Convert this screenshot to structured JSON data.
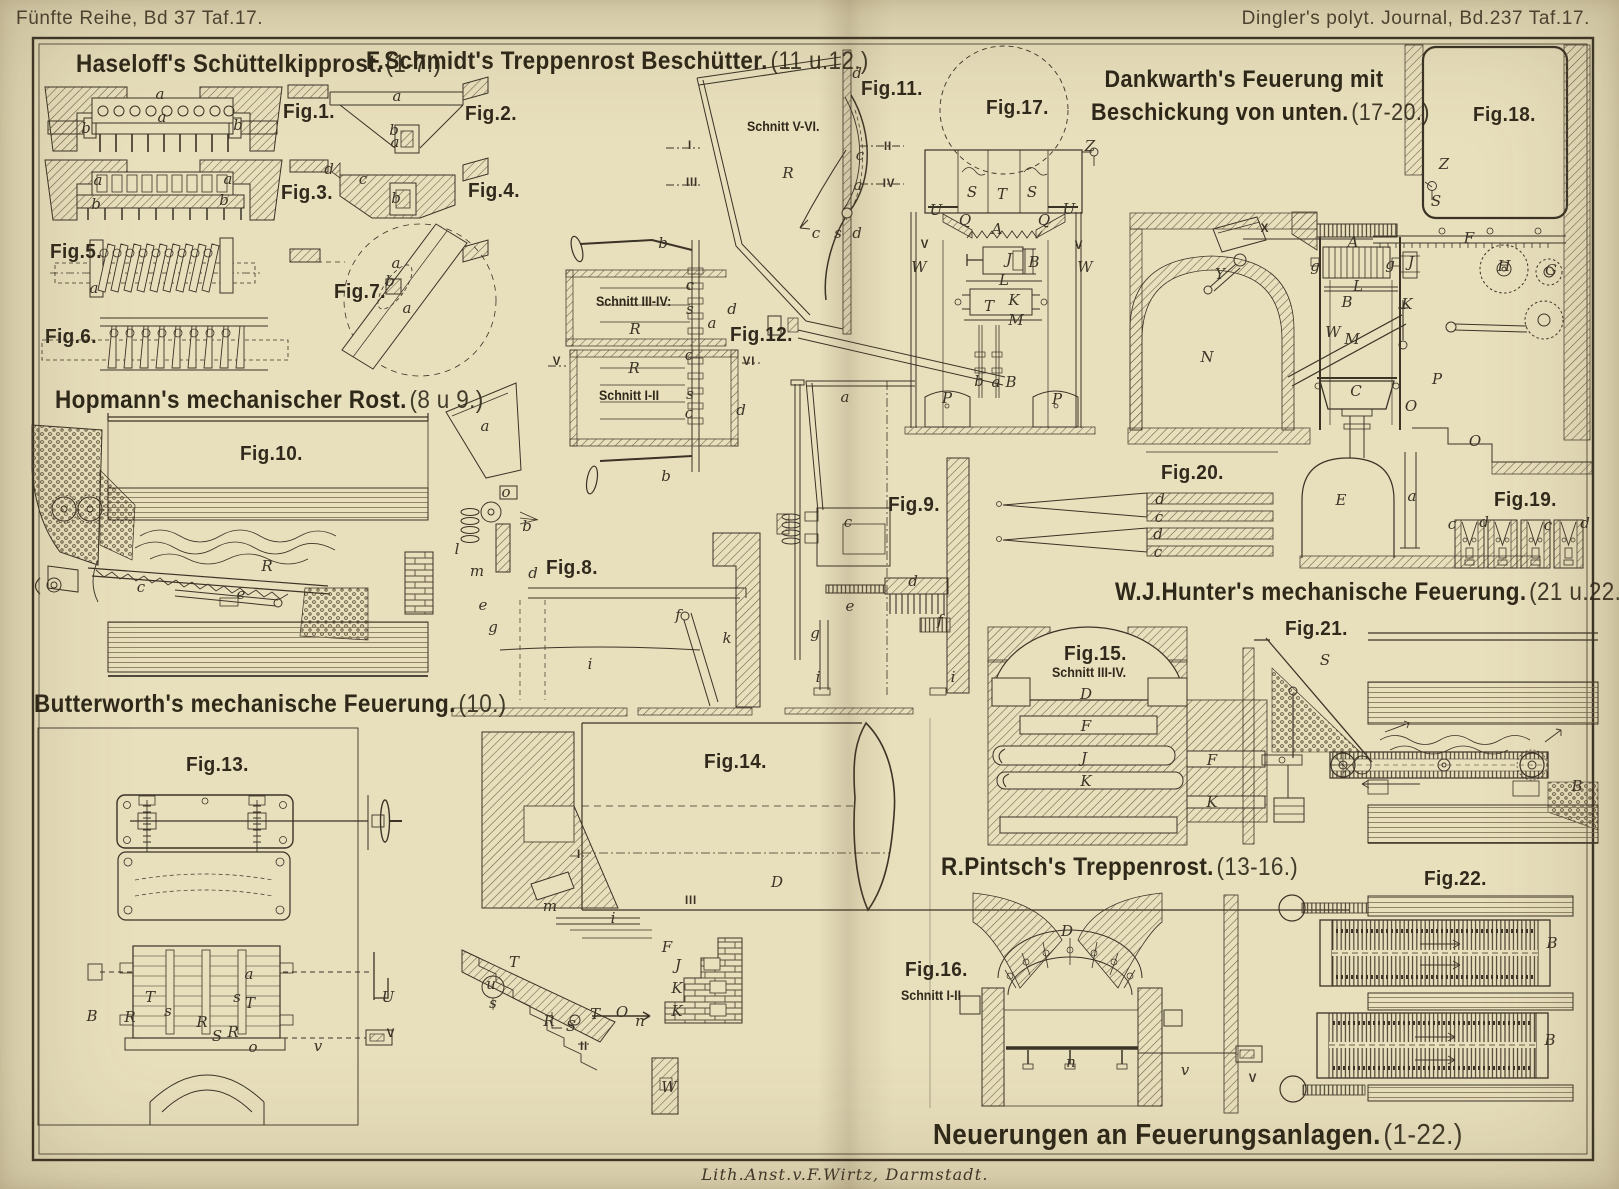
{
  "page": {
    "header_left": "Fünfte Reihe, Bd 37 Taf.17.",
    "header_right": "Dingler's polyt. Journal, Bd.237 Taf.17.",
    "credit": "Lith.Anst.v.F.Wirtz, Darmstadt.",
    "colors": {
      "paper": "#e8dfbd",
      "ink": "#3b3326",
      "hatch": "#6b5c44"
    }
  },
  "titles": {
    "main": {
      "text": "Neuerungen an Feuerungsanlagen.",
      "range": "(1-22.)"
    },
    "haseloff": {
      "text": "Haseloff's Schüttelkipprost.",
      "range": "(1-7.)"
    },
    "schmidt": {
      "text": "F.Schmidt's Treppenrost Beschütter.",
      "range": "(11 u.12.)"
    },
    "dankwarth1": {
      "text": "Dankwarth's Feuerung mit"
    },
    "dankwarth2": {
      "text": "Beschickung von unten.",
      "range": "(17-20.)"
    },
    "hopmann": {
      "text": "Hopmann's mechanischer Rost.",
      "range": "(8 u 9.)"
    },
    "butterworth": {
      "text": "Butterworth's mechanische Feuerung.",
      "range": "(10.)"
    },
    "hunter": {
      "text": "W.J.Hunter's mechanische Feuerung.",
      "range": "(21 u.22.)"
    },
    "pintsch": {
      "text": "R.Pintsch's Treppenrost.",
      "range": "(13-16.)"
    }
  },
  "figures": {
    "f1": {
      "label": "Fig.1."
    },
    "f2": {
      "label": "Fig.2."
    },
    "f3": {
      "label": "Fig.3."
    },
    "f4": {
      "label": "Fig.4."
    },
    "f5": {
      "label": "Fig.5."
    },
    "f6": {
      "label": "Fig.6."
    },
    "f7": {
      "label": "Fig.7."
    },
    "f8": {
      "label": "Fig.8."
    },
    "f9": {
      "label": "Fig.9."
    },
    "f10": {
      "label": "Fig.10."
    },
    "f11": {
      "label": "Fig.11."
    },
    "f12": {
      "label": "Fig.12."
    },
    "f13": {
      "label": "Fig.13."
    },
    "f14": {
      "label": "Fig.14."
    },
    "f15": {
      "label": "Fig.15."
    },
    "f16": {
      "label": "Fig.16."
    },
    "f17": {
      "label": "Fig.17."
    },
    "f18": {
      "label": "Fig.18."
    },
    "f19": {
      "label": "Fig.19."
    },
    "f20": {
      "label": "Fig.20."
    },
    "f21": {
      "label": "Fig.21."
    },
    "f22": {
      "label": "Fig.22."
    }
  },
  "cuts": {
    "c11": "Schnitt V-VI.",
    "c12a": "Schnitt III-IV:",
    "c12b": "Schnitt I-II",
    "c15": "Schnitt III-IV.",
    "c16": "Schnitt I-II"
  },
  "part_labels": [
    {
      "t": "a",
      "x": 160,
      "y": 94
    },
    {
      "t": "a",
      "x": 162,
      "y": 117
    },
    {
      "t": "b",
      "x": 86,
      "y": 128
    },
    {
      "t": "b",
      "x": 238,
      "y": 125
    },
    {
      "t": "a",
      "x": 397,
      "y": 96
    },
    {
      "t": "b",
      "x": 394,
      "y": 130
    },
    {
      "t": "a",
      "x": 395,
      "y": 142
    },
    {
      "t": "a",
      "x": 98,
      "y": 180
    },
    {
      "t": "a",
      "x": 228,
      "y": 179
    },
    {
      "t": "b",
      "x": 96,
      "y": 204
    },
    {
      "t": "b",
      "x": 224,
      "y": 200
    },
    {
      "t": "d",
      "x": 329,
      "y": 169
    },
    {
      "t": "c",
      "x": 363,
      "y": 179
    },
    {
      "t": "b",
      "x": 396,
      "y": 198
    },
    {
      "t": "a",
      "x": 94,
      "y": 288
    },
    {
      "t": "a",
      "x": 396,
      "y": 263
    },
    {
      "t": "b",
      "x": 390,
      "y": 281
    },
    {
      "t": "a",
      "x": 407,
      "y": 308
    },
    {
      "t": "a",
      "x": 485,
      "y": 426
    },
    {
      "t": "o",
      "x": 506,
      "y": 492
    },
    {
      "t": "b",
      "x": 527,
      "y": 526
    },
    {
      "t": "l",
      "x": 457,
      "y": 549
    },
    {
      "t": "m",
      "x": 477,
      "y": 571
    },
    {
      "t": "d",
      "x": 533,
      "y": 573
    },
    {
      "t": "e",
      "x": 483,
      "y": 605
    },
    {
      "t": "g",
      "x": 493,
      "y": 627
    },
    {
      "t": "i",
      "x": 590,
      "y": 664
    },
    {
      "t": "f",
      "x": 678,
      "y": 615
    },
    {
      "t": "k",
      "x": 727,
      "y": 638
    },
    {
      "t": "b",
      "x": 663,
      "y": 243
    },
    {
      "t": "c",
      "x": 690,
      "y": 285
    },
    {
      "t": "s",
      "x": 690,
      "y": 309
    },
    {
      "t": "a",
      "x": 712,
      "y": 323
    },
    {
      "t": "d",
      "x": 732,
      "y": 309
    },
    {
      "t": "R",
      "x": 635,
      "y": 329
    },
    {
      "t": "V",
      "x": 557,
      "y": 362
    },
    {
      "t": "VI",
      "x": 749,
      "y": 362
    },
    {
      "t": "R",
      "x": 634,
      "y": 368
    },
    {
      "t": "c",
      "x": 689,
      "y": 355
    },
    {
      "t": "s",
      "x": 690,
      "y": 394
    },
    {
      "t": "c",
      "x": 689,
      "y": 413
    },
    {
      "t": "d",
      "x": 741,
      "y": 410
    },
    {
      "t": "b",
      "x": 666,
      "y": 476
    },
    {
      "t": "d",
      "x": 857,
      "y": 73
    },
    {
      "t": "c",
      "x": 860,
      "y": 155
    },
    {
      "t": "a",
      "x": 858,
      "y": 185
    },
    {
      "t": "R",
      "x": 788,
      "y": 173
    },
    {
      "t": "I",
      "x": 690,
      "y": 146
    },
    {
      "t": "III",
      "x": 692,
      "y": 183
    },
    {
      "t": "II",
      "x": 888,
      "y": 147
    },
    {
      "t": "IV",
      "x": 889,
      "y": 184
    },
    {
      "t": "c",
      "x": 816,
      "y": 233
    },
    {
      "t": "s",
      "x": 838,
      "y": 233
    },
    {
      "t": "d",
      "x": 857,
      "y": 233
    },
    {
      "t": "T",
      "x": 989,
      "y": 306
    },
    {
      "t": "a",
      "x": 845,
      "y": 397
    },
    {
      "t": "c",
      "x": 848,
      "y": 522
    },
    {
      "t": "d",
      "x": 913,
      "y": 581
    },
    {
      "t": "e",
      "x": 850,
      "y": 606
    },
    {
      "t": "f",
      "x": 940,
      "y": 620
    },
    {
      "t": "g",
      "x": 815,
      "y": 633
    },
    {
      "t": "i",
      "x": 818,
      "y": 677
    },
    {
      "t": "i",
      "x": 953,
      "y": 677
    },
    {
      "t": "R",
      "x": 267,
      "y": 566
    },
    {
      "t": "c",
      "x": 141,
      "y": 587
    },
    {
      "t": "e",
      "x": 241,
      "y": 594
    },
    {
      "t": "a",
      "x": 249,
      "y": 974
    },
    {
      "t": "s",
      "x": 237,
      "y": 997
    },
    {
      "t": "T",
      "x": 150,
      "y": 997
    },
    {
      "t": "T",
      "x": 250,
      "y": 1003
    },
    {
      "t": "s",
      "x": 168,
      "y": 1011
    },
    {
      "t": "B",
      "x": 92,
      "y": 1016
    },
    {
      "t": "R",
      "x": 130,
      "y": 1017
    },
    {
      "t": "R",
      "x": 202,
      "y": 1022
    },
    {
      "t": "R",
      "x": 233,
      "y": 1032
    },
    {
      "t": "S",
      "x": 217,
      "y": 1036
    },
    {
      "t": "o",
      "x": 253,
      "y": 1047
    },
    {
      "t": "v",
      "x": 318,
      "y": 1046
    },
    {
      "t": "U",
      "x": 388,
      "y": 997
    },
    {
      "t": "V",
      "x": 391,
      "y": 1034
    },
    {
      "t": "I",
      "x": 579,
      "y": 855
    },
    {
      "t": "D",
      "x": 777,
      "y": 882
    },
    {
      "t": "III",
      "x": 691,
      "y": 901
    },
    {
      "t": "m",
      "x": 550,
      "y": 906
    },
    {
      "t": "i",
      "x": 613,
      "y": 918
    },
    {
      "t": "T",
      "x": 514,
      "y": 962
    },
    {
      "t": "u",
      "x": 491,
      "y": 984
    },
    {
      "t": "s",
      "x": 493,
      "y": 1003
    },
    {
      "t": "T",
      "x": 595,
      "y": 1014
    },
    {
      "t": "F",
      "x": 667,
      "y": 947
    },
    {
      "t": "J",
      "x": 678,
      "y": 965
    },
    {
      "t": "K",
      "x": 677,
      "y": 988
    },
    {
      "t": "K",
      "x": 677,
      "y": 1011
    },
    {
      "t": "O",
      "x": 622,
      "y": 1012
    },
    {
      "t": "n",
      "x": 640,
      "y": 1021
    },
    {
      "t": "R",
      "x": 549,
      "y": 1021
    },
    {
      "t": "S",
      "x": 571,
      "y": 1026
    },
    {
      "t": "II",
      "x": 584,
      "y": 1047
    },
    {
      "t": "W",
      "x": 669,
      "y": 1087
    },
    {
      "t": "D",
      "x": 1086,
      "y": 694
    },
    {
      "t": "F",
      "x": 1086,
      "y": 726
    },
    {
      "t": "J",
      "x": 1084,
      "y": 758
    },
    {
      "t": "K",
      "x": 1086,
      "y": 781
    },
    {
      "t": "F",
      "x": 1212,
      "y": 760
    },
    {
      "t": "K",
      "x": 1212,
      "y": 802
    },
    {
      "t": "D",
      "x": 1067,
      "y": 931
    },
    {
      "t": "n",
      "x": 1071,
      "y": 1062
    },
    {
      "t": "v",
      "x": 1185,
      "y": 1070
    },
    {
      "t": "V",
      "x": 1253,
      "y": 1079
    },
    {
      "t": "S",
      "x": 972,
      "y": 192
    },
    {
      "t": "T",
      "x": 1002,
      "y": 194
    },
    {
      "t": "S",
      "x": 1032,
      "y": 192
    },
    {
      "t": "Z",
      "x": 1090,
      "y": 146
    },
    {
      "t": "U",
      "x": 936,
      "y": 210
    },
    {
      "t": "U",
      "x": 1069,
      "y": 209
    },
    {
      "t": "Q",
      "x": 965,
      "y": 220
    },
    {
      "t": "Q",
      "x": 1044,
      "y": 220
    },
    {
      "t": "A",
      "x": 997,
      "y": 229
    },
    {
      "t": "V",
      "x": 925,
      "y": 245
    },
    {
      "t": "V",
      "x": 1079,
      "y": 246
    },
    {
      "t": "W",
      "x": 919,
      "y": 267
    },
    {
      "t": "W",
      "x": 1085,
      "y": 267
    },
    {
      "t": "J",
      "x": 1009,
      "y": 259
    },
    {
      "t": "B",
      "x": 1034,
      "y": 262
    },
    {
      "t": "L",
      "x": 1004,
      "y": 280
    },
    {
      "t": "K",
      "x": 1014,
      "y": 300
    },
    {
      "t": "M",
      "x": 1016,
      "y": 320
    },
    {
      "t": "b",
      "x": 979,
      "y": 381
    },
    {
      "t": "a",
      "x": 996,
      "y": 382
    },
    {
      "t": "B",
      "x": 1011,
      "y": 382
    },
    {
      "t": "P",
      "x": 947,
      "y": 398
    },
    {
      "t": "P",
      "x": 1057,
      "y": 399
    },
    {
      "t": "Z",
      "x": 1444,
      "y": 164
    },
    {
      "t": "S",
      "x": 1436,
      "y": 201
    },
    {
      "t": "X",
      "x": 1265,
      "y": 229
    },
    {
      "t": "Y",
      "x": 1220,
      "y": 274
    },
    {
      "t": "A",
      "x": 1353,
      "y": 242
    },
    {
      "t": "g",
      "x": 1315,
      "y": 266
    },
    {
      "t": "g",
      "x": 1390,
      "y": 264
    },
    {
      "t": "J",
      "x": 1411,
      "y": 262
    },
    {
      "t": "L",
      "x": 1358,
      "y": 286
    },
    {
      "t": "B",
      "x": 1347,
      "y": 302
    },
    {
      "t": "K",
      "x": 1407,
      "y": 304
    },
    {
      "t": "W",
      "x": 1333,
      "y": 332
    },
    {
      "t": "M",
      "x": 1352,
      "y": 339
    },
    {
      "t": "N",
      "x": 1207,
      "y": 357
    },
    {
      "t": "C",
      "x": 1356,
      "y": 391
    },
    {
      "t": "P",
      "x": 1437,
      "y": 379
    },
    {
      "t": "O",
      "x": 1411,
      "y": 406
    },
    {
      "t": "O",
      "x": 1475,
      "y": 441
    },
    {
      "t": "F",
      "x": 1469,
      "y": 238
    },
    {
      "t": "H",
      "x": 1504,
      "y": 266
    },
    {
      "t": "G",
      "x": 1551,
      "y": 270
    },
    {
      "t": "E",
      "x": 1341,
      "y": 500
    },
    {
      "t": "a",
      "x": 1412,
      "y": 496
    },
    {
      "t": "c",
      "x": 1452,
      "y": 524
    },
    {
      "t": "d",
      "x": 1484,
      "y": 522
    },
    {
      "t": "c",
      "x": 1548,
      "y": 525
    },
    {
      "t": "d",
      "x": 1585,
      "y": 523
    },
    {
      "t": "d",
      "x": 1160,
      "y": 499
    },
    {
      "t": "c",
      "x": 1159,
      "y": 517
    },
    {
      "t": "d",
      "x": 1158,
      "y": 534
    },
    {
      "t": "c",
      "x": 1158,
      "y": 552
    },
    {
      "t": "S",
      "x": 1325,
      "y": 660
    },
    {
      "t": "B",
      "x": 1577,
      "y": 786
    },
    {
      "t": "B",
      "x": 1552,
      "y": 943
    },
    {
      "t": "B",
      "x": 1550,
      "y": 1040
    }
  ]
}
